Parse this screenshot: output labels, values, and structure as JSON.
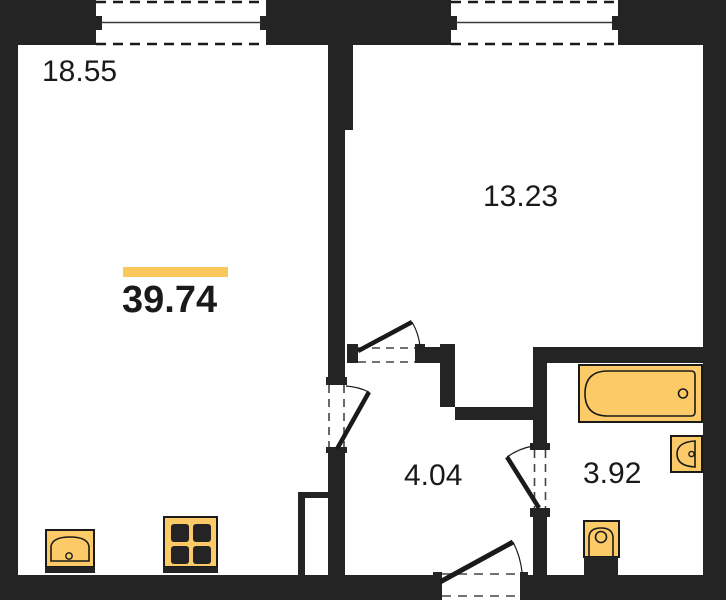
{
  "floor_plan": {
    "total_area": "39.74",
    "rooms": [
      {
        "name": "living-room",
        "area": "18.55"
      },
      {
        "name": "bedroom",
        "area": "13.23"
      },
      {
        "name": "hallway",
        "area": "4.04"
      },
      {
        "name": "bathroom",
        "area": "3.92"
      }
    ],
    "fixtures": [
      {
        "icon": "window-icon"
      },
      {
        "icon": "door-swing-icon"
      },
      {
        "icon": "bathtub-icon"
      },
      {
        "icon": "washbasin-icon"
      },
      {
        "icon": "toilet-icon"
      },
      {
        "icon": "kitchen-sink-icon"
      },
      {
        "icon": "stove-icon"
      },
      {
        "icon": "duct-shaft"
      }
    ],
    "colors": {
      "wall": "#242424",
      "fixture_fill": "#fcca66",
      "accent_bar": "#fbc75c",
      "text": "#1a1a1a",
      "background": "#ffffff"
    }
  }
}
